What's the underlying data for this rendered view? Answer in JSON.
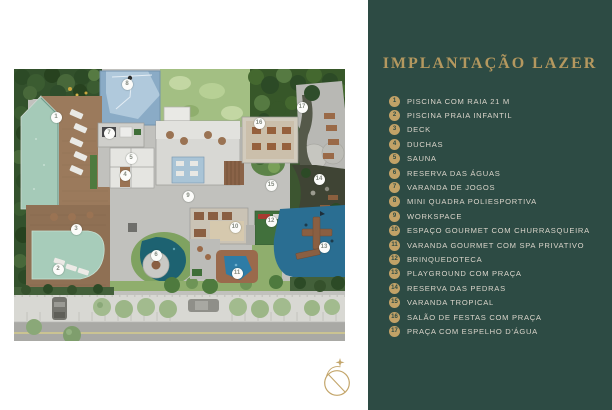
{
  "colors": {
    "panel_bg": "#2d4b44",
    "title_gold": "#b4985f",
    "badge_gold": "#c2a267",
    "legend_text": "#d9d4ca"
  },
  "legend_panel": {
    "title": "IMPLANTAÇÃO LAZER",
    "items": [
      {
        "num": "1",
        "label": "PISCINA COM RAIA 21 M"
      },
      {
        "num": "2",
        "label": "PISCINA PRAIA INFANTIL"
      },
      {
        "num": "3",
        "label": "DECK"
      },
      {
        "num": "4",
        "label": "DUCHAS"
      },
      {
        "num": "5",
        "label": "SAUNA"
      },
      {
        "num": "6",
        "label": "RESERVA DAS ÁGUAS"
      },
      {
        "num": "7",
        "label": "VARANDA DE JOGOS"
      },
      {
        "num": "8",
        "label": "MINI QUADRA POLIESPORTIVA"
      },
      {
        "num": "9",
        "label": "WORKSPACE"
      },
      {
        "num": "10",
        "label": "ESPAÇO GOURMET COM CHURRASQUEIRA"
      },
      {
        "num": "11",
        "label": "VARANDA GOURMET COM SPA PRIVATIVO"
      },
      {
        "num": "12",
        "label": "BRINQUEDOTECA"
      },
      {
        "num": "13",
        "label": "PLAYGROUND COM PRAÇA"
      },
      {
        "num": "14",
        "label": "RESERVA DAS PEDRAS"
      },
      {
        "num": "15",
        "label": "VARANDA TROPICAL"
      },
      {
        "num": "16",
        "label": "SALÃO DE FESTAS COM PRAÇA"
      },
      {
        "num": "17",
        "label": "PRAÇA COM ESPELHO D'ÁGUA"
      }
    ]
  },
  "site_plan": {
    "markers": [
      {
        "num": "1",
        "x": 42,
        "y": 48
      },
      {
        "num": "2",
        "x": 44,
        "y": 200
      },
      {
        "num": "3",
        "x": 62,
        "y": 160
      },
      {
        "num": "4",
        "x": 111,
        "y": 106
      },
      {
        "num": "5",
        "x": 117,
        "y": 89
      },
      {
        "num": "6",
        "x": 142,
        "y": 186
      },
      {
        "num": "7",
        "x": 95,
        "y": 64
      },
      {
        "num": "8",
        "x": 113,
        "y": 15
      },
      {
        "num": "9",
        "x": 174,
        "y": 127
      },
      {
        "num": "10",
        "x": 221,
        "y": 158
      },
      {
        "num": "11",
        "x": 223,
        "y": 204
      },
      {
        "num": "12",
        "x": 257,
        "y": 152
      },
      {
        "num": "13",
        "x": 310,
        "y": 178
      },
      {
        "num": "14",
        "x": 305,
        "y": 110
      },
      {
        "num": "15",
        "x": 257,
        "y": 116
      },
      {
        "num": "16",
        "x": 245,
        "y": 54
      },
      {
        "num": "17",
        "x": 288,
        "y": 38
      }
    ]
  }
}
